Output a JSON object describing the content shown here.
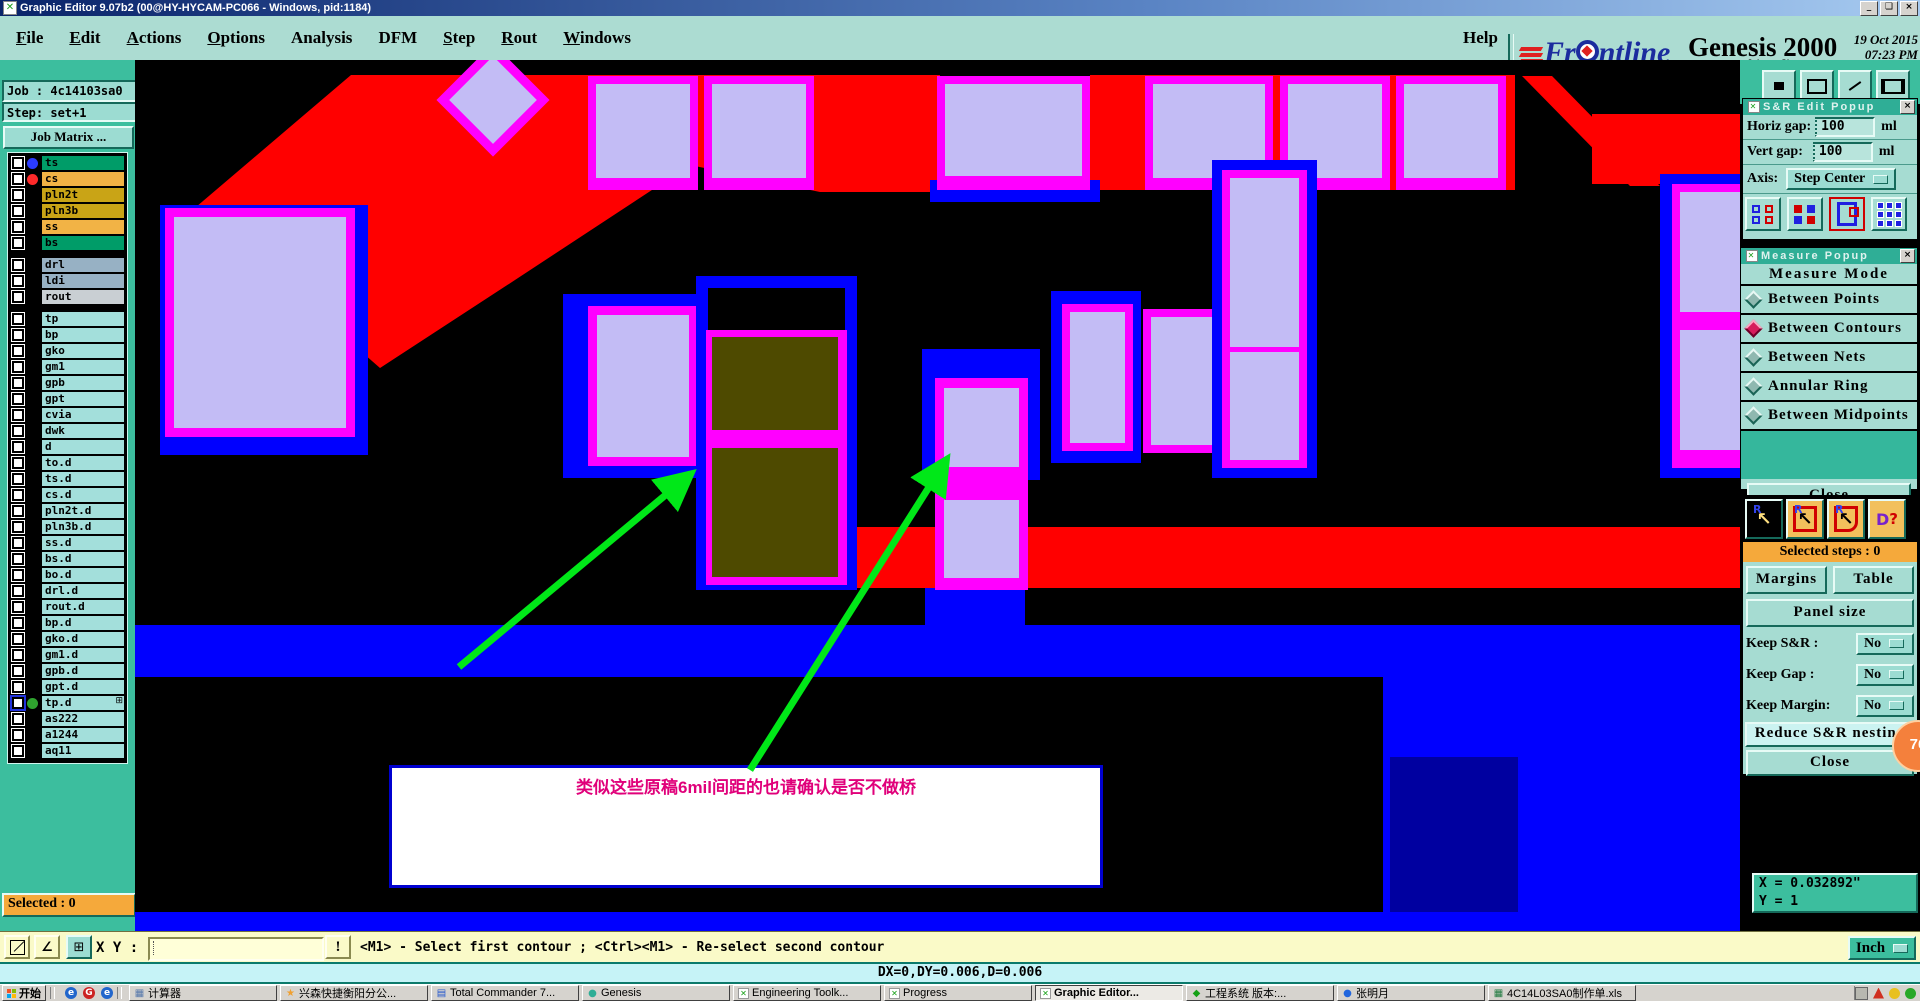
{
  "window": {
    "title": "Graphic Editor 9.07b2 (00@HY-HYCAM-PC066 - Windows, pid:1184)"
  },
  "menu": {
    "items": [
      {
        "label": "File",
        "u": true
      },
      {
        "label": "Edit",
        "u": true
      },
      {
        "label": "Actions",
        "u": true
      },
      {
        "label": "Options",
        "u": true
      },
      {
        "label": "Analysis",
        "u": false
      },
      {
        "label": "DFM",
        "u": false
      },
      {
        "label": "Step",
        "u": true
      },
      {
        "label": "Rout",
        "u": true
      },
      {
        "label": "Windows",
        "u": true
      }
    ],
    "help": "Help"
  },
  "brand": {
    "name_pre": "Fr",
    "name_post": "ntline",
    "product": "Genesis 2000",
    "date": "19 Oct 2015",
    "time": "07:23 PM",
    "subtitle": "Graphic Editor"
  },
  "sidebar": {
    "job": "Job : 4c14103sa0",
    "step": "Step: set+1",
    "job_matrix": "Job Matrix ...",
    "selected": "Selected : 0",
    "layer_groups": [
      [
        {
          "name": "ts",
          "bg": "#009C68",
          "dot": "#2B3BFF"
        },
        {
          "name": "cs",
          "bg": "#F2B345",
          "dot": "#FF2A2A"
        },
        {
          "name": "pln2t",
          "bg": "#C9A416"
        },
        {
          "name": "pln3b",
          "bg": "#C9A416"
        },
        {
          "name": "ss",
          "bg": "#F2B345"
        },
        {
          "name": "bs",
          "bg": "#009C68"
        }
      ],
      [
        {
          "name": "drl",
          "bg": "#97B1C4"
        },
        {
          "name": "ldi",
          "bg": "#97B1C4"
        },
        {
          "name": "rout",
          "bg": "#C9CFD3"
        }
      ],
      [
        {
          "name": "tp",
          "bg": "#A3DFDB"
        },
        {
          "name": "bp",
          "bg": "#A3DFDB"
        },
        {
          "name": "gko",
          "bg": "#A3DFDB"
        },
        {
          "name": "gm1",
          "bg": "#A3DFDB"
        },
        {
          "name": "gpb",
          "bg": "#A3DFDB"
        },
        {
          "name": "gpt",
          "bg": "#A3DFDB"
        },
        {
          "name": "cvia",
          "bg": "#A3DFDB"
        },
        {
          "name": "dwk",
          "bg": "#A3DFDB"
        },
        {
          "name": "d",
          "bg": "#A3DFDB"
        },
        {
          "name": "to.d",
          "bg": "#A3DFDB"
        },
        {
          "name": "ts.d",
          "bg": "#A3DFDB"
        },
        {
          "name": "cs.d",
          "bg": "#A3DFDB"
        },
        {
          "name": "pln2t.d",
          "bg": "#A3DFDB"
        },
        {
          "name": "pln3b.d",
          "bg": "#A3DFDB"
        },
        {
          "name": "ss.d",
          "bg": "#A3DFDB"
        },
        {
          "name": "bs.d",
          "bg": "#A3DFDB"
        },
        {
          "name": "bo.d",
          "bg": "#A3DFDB"
        },
        {
          "name": "drl.d",
          "bg": "#A3DFDB"
        },
        {
          "name": "rout.d",
          "bg": "#A3DFDB"
        },
        {
          "name": "bp.d",
          "bg": "#A3DFDB"
        },
        {
          "name": "gko.d",
          "bg": "#A3DFDB"
        },
        {
          "name": "gm1.d",
          "bg": "#A3DFDB"
        },
        {
          "name": "gpb.d",
          "bg": "#A3DFDB"
        },
        {
          "name": "gpt.d",
          "bg": "#A3DFDB"
        },
        {
          "name": "tp.d",
          "bg": "#A3DFDB",
          "dot": "#2FA32F",
          "selected": true,
          "grid": true
        },
        {
          "name": "as222",
          "bg": "#A3DFDB"
        },
        {
          "name": "a1244",
          "bg": "#A3DFDB"
        },
        {
          "name": "aq11",
          "bg": "#A3DFDB"
        }
      ]
    ]
  },
  "canvas": {
    "annotation": "类似这些原稿6mil间距的也请确认是否不做桥"
  },
  "sr_edit_popup": {
    "title": "S&R Edit Popup",
    "horiz_label": "Horiz gap:",
    "horiz_value": "100",
    "horiz_unit": "ml",
    "vert_label": "Vert gap:",
    "vert_value": "100",
    "vert_unit": "ml",
    "axis_label": "Axis:",
    "axis_value": "Step Center"
  },
  "measure_popup": {
    "title": "Measure Popup",
    "header": "Measure Mode",
    "modes": [
      {
        "label": "Between Points",
        "selected": false
      },
      {
        "label": "Between Contours",
        "selected": true
      },
      {
        "label": "Between Nets",
        "selected": false
      },
      {
        "label": "Annular Ring",
        "selected": false
      },
      {
        "label": "Between Midpoints",
        "selected": false
      }
    ],
    "close": "Close"
  },
  "sr_tools": {
    "selected_steps": "Selected steps : 0",
    "margins": "Margins",
    "table": "Table",
    "panel_size": "Panel size",
    "keep_rows": [
      {
        "label": "Keep S&R  :",
        "value": "No"
      },
      {
        "label": "Keep Gap   :",
        "value": "No"
      },
      {
        "label": "Keep Margin:",
        "value": "No"
      }
    ],
    "reduce": "Reduce S&R nesting",
    "badge": "76",
    "close": "Close"
  },
  "readout": {
    "x": "X = 0.032892\"",
    "y": "Y = 1",
    "unit": "Inch"
  },
  "command_bar": {
    "xy_label": "X Y :",
    "input_value": "",
    "status": "<M1> - Select first contour ; <Ctrl><M1> - Re-select second contour"
  },
  "delta_bar": {
    "text": "DX=0,DY=0.006,D=0.006"
  },
  "taskbar": {
    "start": "开始",
    "quick": [
      "e",
      "G",
      "e"
    ],
    "tasks": [
      {
        "label": "计算器",
        "icon": "calc"
      },
      {
        "label": "兴森快捷衡阳分公...",
        "icon": "star"
      },
      {
        "label": "Total Commander 7...",
        "icon": "tc"
      },
      {
        "label": "Genesis",
        "icon": "globe"
      },
      {
        "label": "Engineering Toolk...",
        "icon": "gx"
      },
      {
        "label": "Progress",
        "icon": "gx"
      },
      {
        "label": "Graphic Editor...",
        "icon": "gx",
        "active": true
      },
      {
        "label": "工程系统  版本:...",
        "icon": "sys"
      },
      {
        "label": "张明月",
        "icon": "qq"
      },
      {
        "label": "4C14L03SA0制作单.xls",
        "icon": "xls"
      }
    ]
  },
  "colors": {
    "teal": "#3CBE9E",
    "panel": "#A6DCD2",
    "red": "#FF0000",
    "blue": "#0000FF",
    "magenta": "#FF00FF",
    "lavender": "#C3BCF5",
    "olive": "#4E4A00",
    "orange_banner": "#F5A93B",
    "annotation_pink": "#E0007A"
  }
}
